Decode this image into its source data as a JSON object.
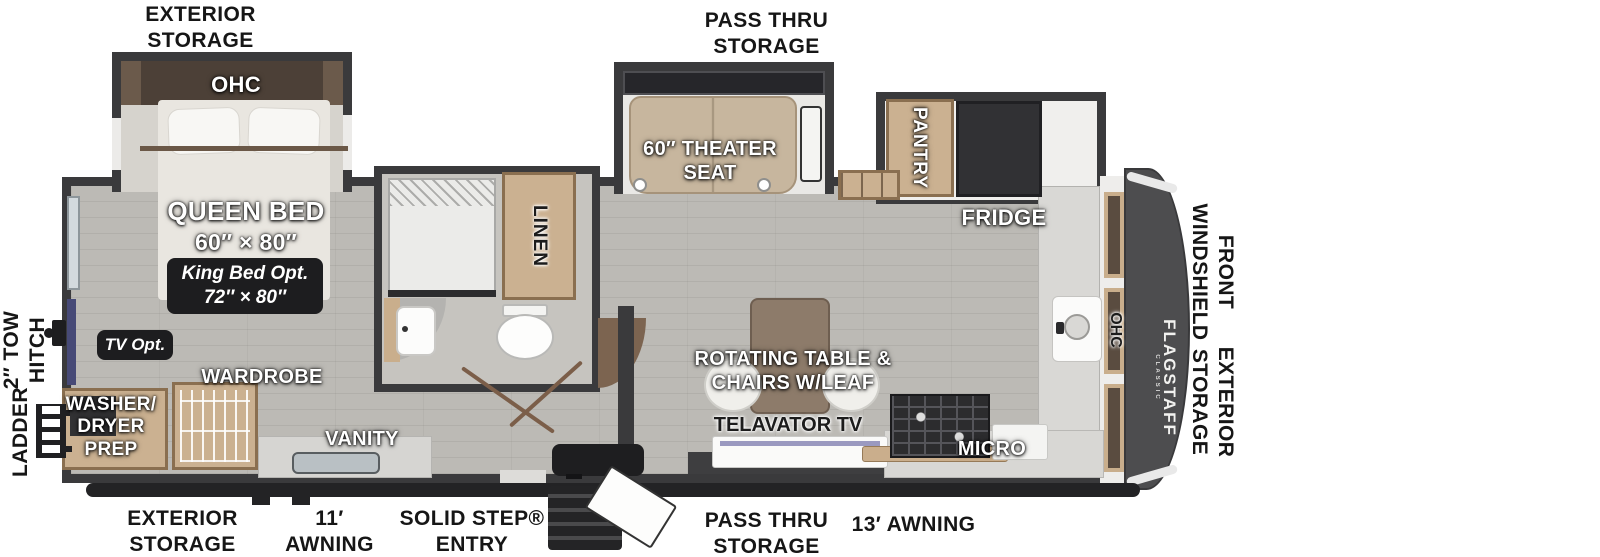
{
  "exterior": {
    "top_rear_storage": "EXTERIOR\nSTORAGE",
    "top_pass_thru": "PASS THRU\nSTORAGE",
    "left_tow_hitch": "2″ TOW\nHITCH",
    "left_ladder": "LADDER",
    "right_front_windshield": "FRONT\nWINDSHIELD",
    "right_exterior_storage": "EXTERIOR\nSTORAGE",
    "bottom_rear_storage": "EXTERIOR\nSTORAGE",
    "bottom_awning_rear": "11′\nAWNING",
    "bottom_entry": "SOLID STEP®\nENTRY",
    "bottom_pass_thru": "PASS THRU\nSTORAGE",
    "bottom_awning_front": "13′ AWNING"
  },
  "bedroom": {
    "ohc": "OHC",
    "bed_name": "QUEEN BED",
    "bed_size": "60″ × 80″",
    "king_bed_option": "King Bed Opt.\n72″ × 80″",
    "tv_option": "TV Opt.",
    "wardrobe": "WARDROBE",
    "washer_dryer": "WASHER/\nDRYER\nPREP"
  },
  "bathroom": {
    "linen": "LINEN",
    "vanity": "VANITY"
  },
  "living": {
    "theater_seat": "60″ THEATER\nSEAT",
    "table": "ROTATING TABLE &\nCHAIRS W/LEAF",
    "tv_lift": "TELAVATOR TV"
  },
  "kitchen": {
    "pantry": "PANTRY",
    "fridge": "FRIDGE",
    "micro": "MICRO",
    "ohc": "OHC"
  },
  "brand": {
    "name": "FLAGSTAFF",
    "series": "CLASSIC"
  }
}
